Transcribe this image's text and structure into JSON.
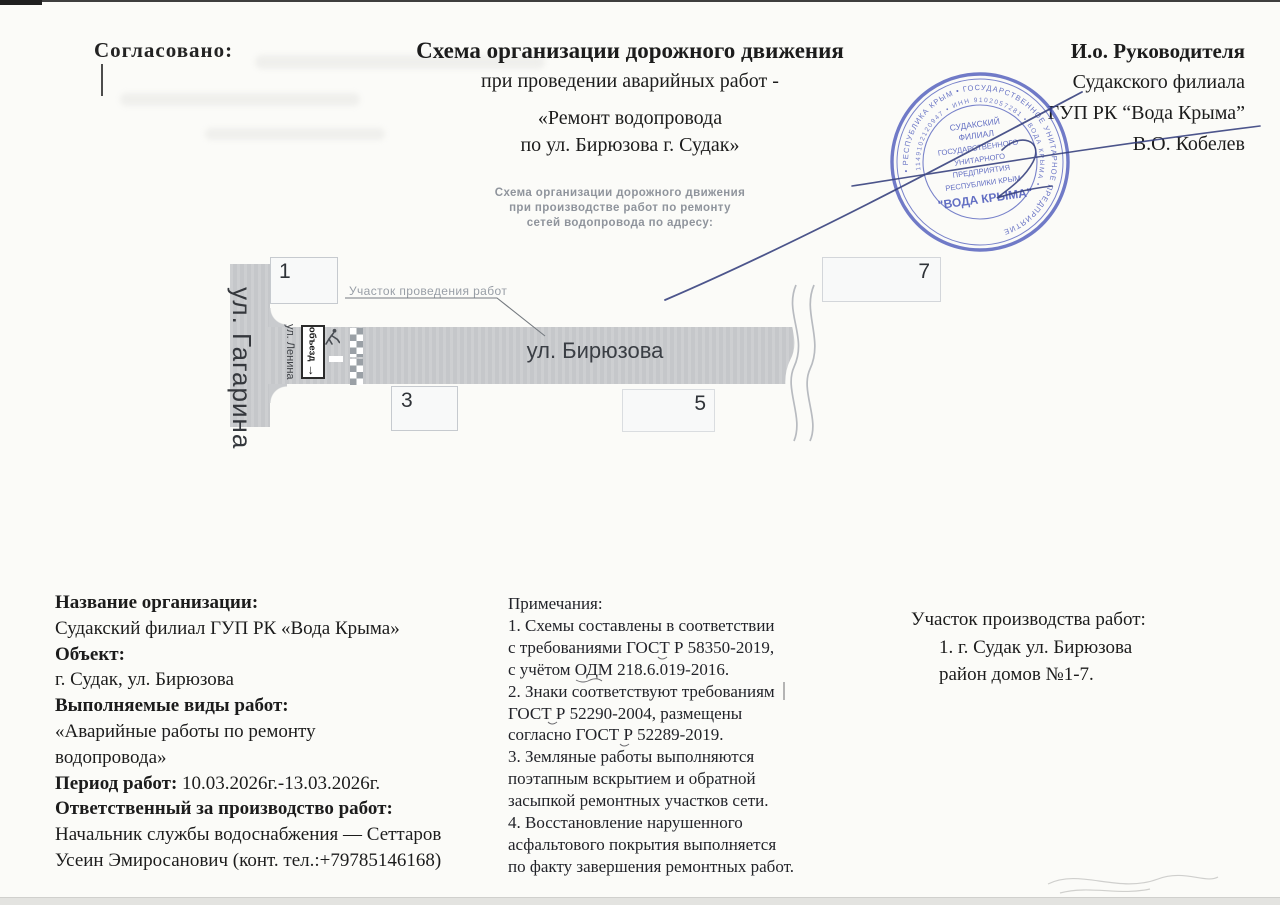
{
  "header": {
    "agreed": "Согласовано:",
    "title1": "Схема организации дорожного движения",
    "title2": "при проведении аварийных работ -",
    "title3": "«Ремонт водопровода",
    "title4": "по ул. Бирюзова г. Судак»",
    "approver1": "И.о. Руководителя",
    "approver2": "Судакского филиала",
    "approver3": "ГУП РК “Вода Крыма”",
    "approver4": "В.О. Кобелев"
  },
  "stamp": {
    "color": "#4553b8",
    "ring_outer": "• РЕСПУБЛИКА КРЫМ • ГОСУДАРСТВЕННОЕ УНИТАРНОЕ ПРЕДПРИЯТИЕ",
    "ring_inner": "1149102120947 • ИНН 9102057281 • ВОДА КРЫМА •",
    "center": [
      "СУДАКСКИЙ",
      "ФИЛИАЛ",
      "ГОСУДАРСТВЕННОГО",
      "УНИТАРНОГО",
      "ПРЕДПРИЯТИЯ",
      "РЕСПУБЛИКИ КРЫМ",
      "\"ВОДА КРЫМА\""
    ]
  },
  "diagram": {
    "scheme_title1": "Схема организации дорожного движения",
    "scheme_title2": "при производстве работ по ремонту",
    "scheme_title3": "сетей водопровода по адресу:",
    "work_area_label": "Участок проведения работ",
    "street_gagarina": "ул. Гагарина",
    "street_lenina": "ул. Ленина",
    "street_biryuzova": "ул. Бирюзова",
    "detour_sign": "объезд",
    "detour_arrow": "→",
    "box1": "1",
    "box3": "3",
    "box5": "5",
    "box7": "7",
    "road_color": "#c9cbce"
  },
  "info": {
    "org_label": "Название организации:",
    "org_value": "Судакский филиал ГУП РК «Вода Крыма»",
    "object_label": "Объект:",
    "object_value": "г. Судак, ул. Бирюзова",
    "works_label": "Выполняемые виды работ:",
    "works_value1": "«Аварийные работы по ремонту",
    "works_value2": "водопровода»",
    "period_label": "Период работ:",
    "period_value": " 10.03.2026г.-13.03.2026г.",
    "resp_label": "Ответственный за производство работ:",
    "resp_value1": "Начальник службы водоснабжения — Сеттаров",
    "resp_value2": "Усеин Эмиросанович (конт. тел.:+79785146168)"
  },
  "notes": {
    "title": "Примечания:",
    "lines": [
      "1. Схемы составлены в соответствии",
      "с требованиями ГОСТ Р 58350-2019,",
      "с учётом ОДМ 218.6.019-2016.",
      "2. Знаки соответствуют требованиям",
      "ГОСТ Р 52290-2004, размещены",
      "согласно ГОСТ Р 52289-2019.",
      "3. Земляные работы выполняются",
      "поэтапным вскрытием и обратной",
      "засыпкой ремонтных участков сети.",
      "4. Восстановление нарушенного",
      "асфальтового покрытия выполняется",
      "по факту завершения ремонтных работ."
    ]
  },
  "worksite": {
    "title": "Участок производства работ:",
    "line1": "1.   г. Судак ул. Бирюзова",
    "line2": "район домов №1-7."
  }
}
